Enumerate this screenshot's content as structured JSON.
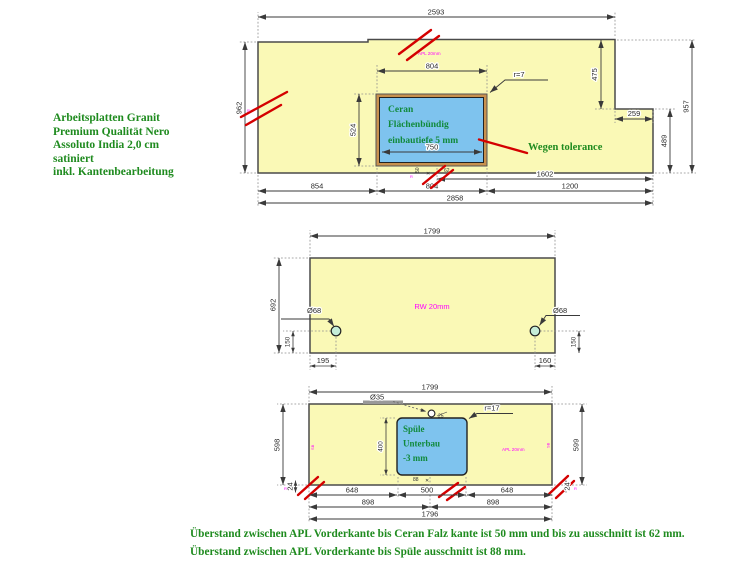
{
  "note": {
    "lines": [
      "Arbeitsplatten Granit",
      "Premium Qualität Nero",
      "Assoluto India 2,0 cm",
      "satiniert",
      "inkl. Kantenbearbeitung"
    ]
  },
  "footer": {
    "lines": [
      "Überstand zwischen APL Vorderkante bis Ceran Falz kante ist 50 mm und bis zu ausschnitt ist 62 mm.",
      "Überstand zwischen APL Vorderkante bis Spüle ausschnitt ist 88 mm."
    ]
  },
  "colors": {
    "plate_fill": "#faf9b6",
    "plate_border": "#4a4a4a",
    "cutout_fill": "#7ec3ee",
    "cutout_frame": "#c8914e",
    "hole_fill": "#c5edd8",
    "edge_red": "#d40000",
    "magenta": "#ff00ff",
    "green": "#1f8b1f",
    "dim": "#2b2b2b"
  },
  "plate1": {
    "w_top": "2593",
    "h_left": "962",
    "h_right": "957",
    "h_step_upper": "475",
    "w_step": "259",
    "h_step_lower": "489",
    "w_mid": "1602",
    "w_b1": "854",
    "w_b2": "804",
    "w_b3": "1200",
    "w_total": "2858",
    "cut_w": "804",
    "cut_h": "524",
    "cut_w_inner": "750",
    "cut_radius": "r=7",
    "cut_lines": [
      "Ceran",
      "Flächenbündig",
      "einbautiefe 5 mm"
    ],
    "tolerance_note": "Wegen tolerance",
    "edge_note": "APL 20mm",
    "tiny_left": "50",
    "tiny_x": "✕",
    "tiny_right": "62",
    "edge_mark": "R"
  },
  "plate2": {
    "w_top": "1799",
    "h_left": "692",
    "surface_note": "RW 20mm",
    "hole_left": "Ø68",
    "hole_right": "Ø68",
    "off_left": "195",
    "up_left": "150",
    "off_right": "160",
    "up_right": "150"
  },
  "plate3": {
    "w_top": "1799",
    "h_left": "598",
    "h_right": "599",
    "hole": "Ø35",
    "hole_note": "25",
    "cut_radius": "r=17",
    "cut_lines": [
      "Spüle",
      "Unterbau",
      "-3 mm"
    ],
    "cut_h": "400",
    "edge_note": "APL 20mm",
    "edge_mark_left": "SB",
    "edge_mark_right": "SB",
    "corner_left": "24",
    "corner_right": "24",
    "corner_mark": "R",
    "tiny": "88",
    "tiny_x": "✕",
    "w_b1": "648",
    "w_b2": "500",
    "w_b3": "648",
    "w_c1": "898",
    "w_c2": "898",
    "w_total": "1796"
  }
}
